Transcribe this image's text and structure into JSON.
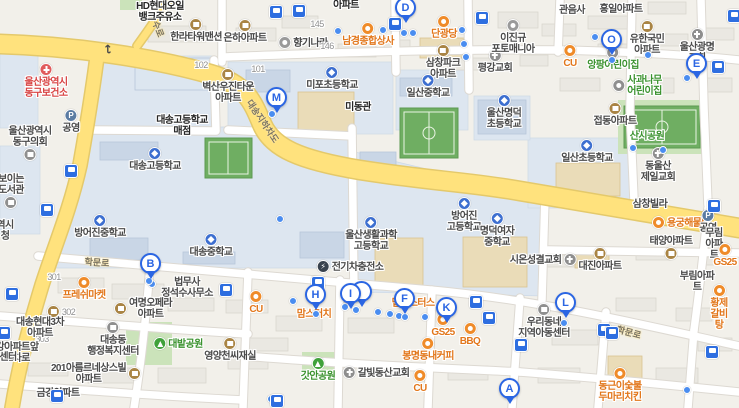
{
  "colors": {
    "accent_blue": "#2b66e3",
    "poi_orange": "#e2761a",
    "park_green": "#3a922e",
    "health_red": "#d84444",
    "road_yellow": "#ffe27d",
    "school_zone_blue": "#dde6f0"
  },
  "map": {
    "uturn_symbol": "↩",
    "road_labels": [
      {
        "text": "봉수로",
        "x": 157,
        "y": 25,
        "rot": 68
      },
      {
        "text": "대송지하차도",
        "x": 263,
        "y": 121,
        "rot": 56
      },
      {
        "text": "학문로",
        "x": 97,
        "y": 262,
        "rot": 4
      },
      {
        "text": "학문로",
        "x": 629,
        "y": 332,
        "rot": 15
      }
    ],
    "pois": [
      {
        "text": "HD현대오일\n뱅크주유소",
        "x": 160,
        "y": 1,
        "cls": "blk"
      },
      {
        "text": "한라타워맨션",
        "x": 196,
        "y": 18,
        "icon": "apt"
      },
      {
        "text": "은하아파트",
        "x": 245,
        "y": 19,
        "icon": "apt"
      },
      {
        "text": "향기나라",
        "x": 303,
        "y": 36,
        "icon": "shop-grey",
        "ipos": "left"
      },
      {
        "text": "145",
        "x": 317,
        "y": 19,
        "cls": "num"
      },
      {
        "text": "146",
        "x": 327,
        "y": 41,
        "cls": "num"
      },
      {
        "text": "101",
        "x": 258,
        "y": 64,
        "cls": "num"
      },
      {
        "text": "102",
        "x": 201,
        "y": 60,
        "cls": "num"
      },
      {
        "text": "아파트",
        "x": 346,
        "y": 0,
        "cls": "blk"
      },
      {
        "text": "남경종합상사",
        "x": 368,
        "y": 22,
        "cls": "org",
        "icon": "shop"
      },
      {
        "text": "단광당",
        "x": 444,
        "y": 15,
        "cls": "org",
        "icon": "shop"
      },
      {
        "text": "삼창파크\n아파트",
        "x": 443,
        "y": 44,
        "icon": "apt"
      },
      {
        "text": "평강교회",
        "x": 495,
        "y": 49,
        "icon": "church"
      },
      {
        "text": "이진규\n포토매니아",
        "x": 513,
        "y": 19,
        "icon": "shop-grey"
      },
      {
        "text": "관음사",
        "x": 572,
        "y": 5
      },
      {
        "text": "홍일아파트",
        "x": 621,
        "y": 4
      },
      {
        "text": "유한국민\n아파트",
        "x": 647,
        "y": 20,
        "icon": "apt"
      },
      {
        "text": "울산광명교회",
        "x": 697,
        "y": 28,
        "icon": "church"
      },
      {
        "text": "CU",
        "x": 570,
        "y": 44,
        "cls": "org",
        "icon": "cu"
      },
      {
        "text": "앙팡어린이집",
        "x": 613,
        "y": 46,
        "cls": "grn",
        "icon": "kid"
      },
      {
        "text": "사과나무\n어린이집",
        "x": 637,
        "y": 75,
        "cls": "grn",
        "icon": "kid",
        "ipos": "left"
      },
      {
        "text": "접동아파트",
        "x": 615,
        "y": 102,
        "icon": "apt"
      },
      {
        "text": "벽산우진타운\n아파트",
        "x": 228,
        "y": 68,
        "icon": "apt"
      },
      {
        "text": "미포초등학교",
        "x": 332,
        "y": 66,
        "icon": "school"
      },
      {
        "text": "일산중학교",
        "x": 428,
        "y": 74,
        "icon": "school"
      },
      {
        "text": "미동관",
        "x": 358,
        "y": 102,
        "cls": "blk"
      },
      {
        "text": "울산명덕\n초등학교",
        "x": 504,
        "y": 94,
        "icon": "school"
      },
      {
        "text": "대송고등학교\n매점",
        "x": 182,
        "y": 115,
        "cls": "blk"
      },
      {
        "text": "울산광역시\n동구보건소",
        "x": 46,
        "y": 63,
        "cls": "red",
        "icon": "hosp"
      },
      {
        "text": "공영",
        "x": 71,
        "y": 109,
        "cls": "pk",
        "icon": "pmark"
      },
      {
        "text": "울산광역시\n동구의회",
        "x": 30,
        "y": 126,
        "icon": "gov",
        "ipos": "below"
      },
      {
        "text": "보이는\n도서관",
        "x": 11,
        "y": 174,
        "icon": "gov",
        "ipos": "below"
      },
      {
        "text": "역시\n청",
        "x": 5,
        "y": 220
      },
      {
        "text": "대송고등학교",
        "x": 155,
        "y": 147,
        "icon": "school"
      },
      {
        "text": "방어진중학교",
        "x": 100,
        "y": 214,
        "icon": "school"
      },
      {
        "text": "대송중학교",
        "x": 211,
        "y": 233,
        "icon": "school"
      },
      {
        "text": "울산생활과학\n고등학교",
        "x": 371,
        "y": 216,
        "icon": "school"
      },
      {
        "text": "방어진\n고등학교",
        "x": 464,
        "y": 197,
        "icon": "school"
      },
      {
        "text": "명덕여자\n중학교",
        "x": 497,
        "y": 212,
        "icon": "school"
      },
      {
        "text": "전기차충전소",
        "x": 350,
        "y": 260,
        "icon": "ev",
        "ipos": "left"
      },
      {
        "text": "일산초등학교",
        "x": 587,
        "y": 139,
        "icon": "school"
      },
      {
        "text": "산시공원",
        "x": 647,
        "y": 131,
        "cls": "grn"
      },
      {
        "text": "동울산\n제일교회",
        "x": 658,
        "y": 147,
        "icon": "church"
      },
      {
        "text": "삼창빌라",
        "x": 650,
        "y": 199
      },
      {
        "text": "용궁해물탕",
        "x": 681,
        "y": 216,
        "cls": "org",
        "icon": "food",
        "ipos": "left"
      },
      {
        "text": "공영",
        "x": 708,
        "y": 209,
        "cls": "pk",
        "icon": "pmark"
      },
      {
        "text": "태양아파트",
        "x": 671,
        "y": 236,
        "icon": "apt",
        "ipos": "below"
      },
      {
        "text": "무림아파트",
        "x": 714,
        "y": 228
      },
      {
        "text": "GS25",
        "x": 725,
        "y": 243,
        "cls": "org",
        "icon": "gs"
      },
      {
        "text": "시온성결교회",
        "x": 543,
        "y": 253,
        "icon": "church",
        "ipos": "right"
      },
      {
        "text": "대진아파트",
        "x": 600,
        "y": 247,
        "icon": "apt"
      },
      {
        "text": "부림아파트",
        "x": 697,
        "y": 271
      },
      {
        "text": "황제갈비탕",
        "x": 719,
        "y": 284,
        "cls": "org",
        "icon": "food"
      },
      {
        "text": "우리동네\n지역아동센터",
        "x": 544,
        "y": 303,
        "icon": "gov"
      },
      {
        "text": "동근이숯불\n두마리치킨",
        "x": 620,
        "y": 367,
        "cls": "org",
        "icon": "food"
      },
      {
        "text": "맘스터치",
        "x": 314,
        "y": 309,
        "cls": "org"
      },
      {
        "text": "딥로스터스",
        "x": 413,
        "y": 298,
        "cls": "org"
      },
      {
        "text": "GS25",
        "x": 443,
        "y": 313,
        "cls": "org",
        "icon": "gs"
      },
      {
        "text": "BBQ",
        "x": 470,
        "y": 322,
        "cls": "org",
        "icon": "food"
      },
      {
        "text": "봉명동내커피",
        "x": 428,
        "y": 337,
        "cls": "org",
        "icon": "cafe"
      },
      {
        "text": "CU",
        "x": 420,
        "y": 369,
        "cls": "org",
        "icon": "cu"
      },
      {
        "text": "갈빛동산교회",
        "x": 376,
        "y": 366,
        "icon": "church",
        "ipos": "left"
      },
      {
        "text": "갓안공원",
        "x": 318,
        "y": 357,
        "cls": "grn",
        "icon": "tree"
      },
      {
        "text": "CU",
        "x": 256,
        "y": 290,
        "cls": "org",
        "icon": "cu"
      },
      {
        "text": "프레쉬마켓",
        "x": 84,
        "y": 276,
        "cls": "org",
        "icon": "shop"
      },
      {
        "text": "법무사\n정석수사무소",
        "x": 187,
        "y": 277
      },
      {
        "text": "여명오페라\n아파트",
        "x": 143,
        "y": 298,
        "icon": "apt",
        "ipos": "left"
      },
      {
        "text": "대송동\n행정복지센터",
        "x": 113,
        "y": 321,
        "icon": "gov"
      },
      {
        "text": "대밭공원",
        "x": 178,
        "y": 337,
        "cls": "grn",
        "icon": "tree",
        "ipos": "left"
      },
      {
        "text": "영양천씨재실",
        "x": 230,
        "y": 337,
        "icon": "apt"
      },
      {
        "text": "301",
        "x": 54,
        "y": 272,
        "cls": "num"
      },
      {
        "text": "302",
        "x": 61,
        "y": 305,
        "cls": "num",
        "icon": "apt",
        "ipos": "left"
      },
      {
        "text": "303",
        "x": 42,
        "y": 334,
        "cls": "num"
      },
      {
        "text": "대송현대3차\n아파트",
        "x": 40,
        "y": 317
      },
      {
        "text": "강아파트앞\n교차로",
        "x": 17,
        "y": 342
      },
      {
        "text": "201아름르네상스빌\n아파트",
        "x": 96,
        "y": 363,
        "icon": "apt",
        "ipos": "right"
      },
      {
        "text": "금강아파트",
        "x": 58,
        "y": 388
      },
      {
        "text": "센터",
        "x": 8,
        "y": 352
      }
    ],
    "markers": [
      {
        "letter": "D",
        "x": 406,
        "y": 8
      },
      {
        "letter": "M",
        "x": 277,
        "y": 98
      },
      {
        "letter": "O",
        "x": 612,
        "y": 40
      },
      {
        "letter": "E",
        "x": 697,
        "y": 64
      },
      {
        "letter": "B",
        "x": 151,
        "y": 264
      },
      {
        "letter": "H",
        "x": 316,
        "y": 295
      },
      {
        "letter": "",
        "x": 362,
        "y": 292,
        "ghost": true
      },
      {
        "letter": "I",
        "x": 351,
        "y": 294
      },
      {
        "letter": "F",
        "x": 405,
        "y": 299
      },
      {
        "letter": "K",
        "x": 447,
        "y": 308
      },
      {
        "letter": "L",
        "x": 566,
        "y": 303
      },
      {
        "letter": "A",
        "x": 510,
        "y": 389
      }
    ],
    "bus_stops": [
      [
        276,
        12
      ],
      [
        299,
        11
      ],
      [
        395,
        24
      ],
      [
        482,
        18
      ],
      [
        734,
        16
      ],
      [
        718,
        67
      ],
      [
        714,
        206
      ],
      [
        71,
        171
      ],
      [
        47,
        210
      ],
      [
        318,
        283
      ],
      [
        226,
        290
      ],
      [
        476,
        302
      ],
      [
        489,
        318
      ],
      [
        604,
        330
      ],
      [
        612,
        333
      ],
      [
        521,
        345
      ],
      [
        712,
        352
      ],
      [
        57,
        396
      ],
      [
        277,
        401
      ],
      [
        12,
        294
      ],
      [
        4,
        333
      ]
    ],
    "transit_dots": [
      [
        338,
        31
      ],
      [
        383,
        30
      ],
      [
        404,
        33
      ],
      [
        413,
        33
      ],
      [
        462,
        30
      ],
      [
        464,
        44
      ],
      [
        466,
        57
      ],
      [
        595,
        37
      ],
      [
        648,
        55
      ],
      [
        633,
        148
      ],
      [
        663,
        150
      ],
      [
        280,
        219
      ],
      [
        152,
        284
      ],
      [
        293,
        301
      ],
      [
        345,
        307
      ],
      [
        356,
        310
      ],
      [
        378,
        312
      ],
      [
        390,
        314
      ],
      [
        399,
        316
      ],
      [
        425,
        317
      ],
      [
        687,
        390
      ],
      [
        272,
        114
      ],
      [
        612,
        60
      ],
      [
        687,
        78
      ],
      [
        564,
        323
      ],
      [
        316,
        314
      ],
      [
        149,
        281
      ],
      [
        405,
        317
      ],
      [
        271,
        399
      ]
    ]
  }
}
